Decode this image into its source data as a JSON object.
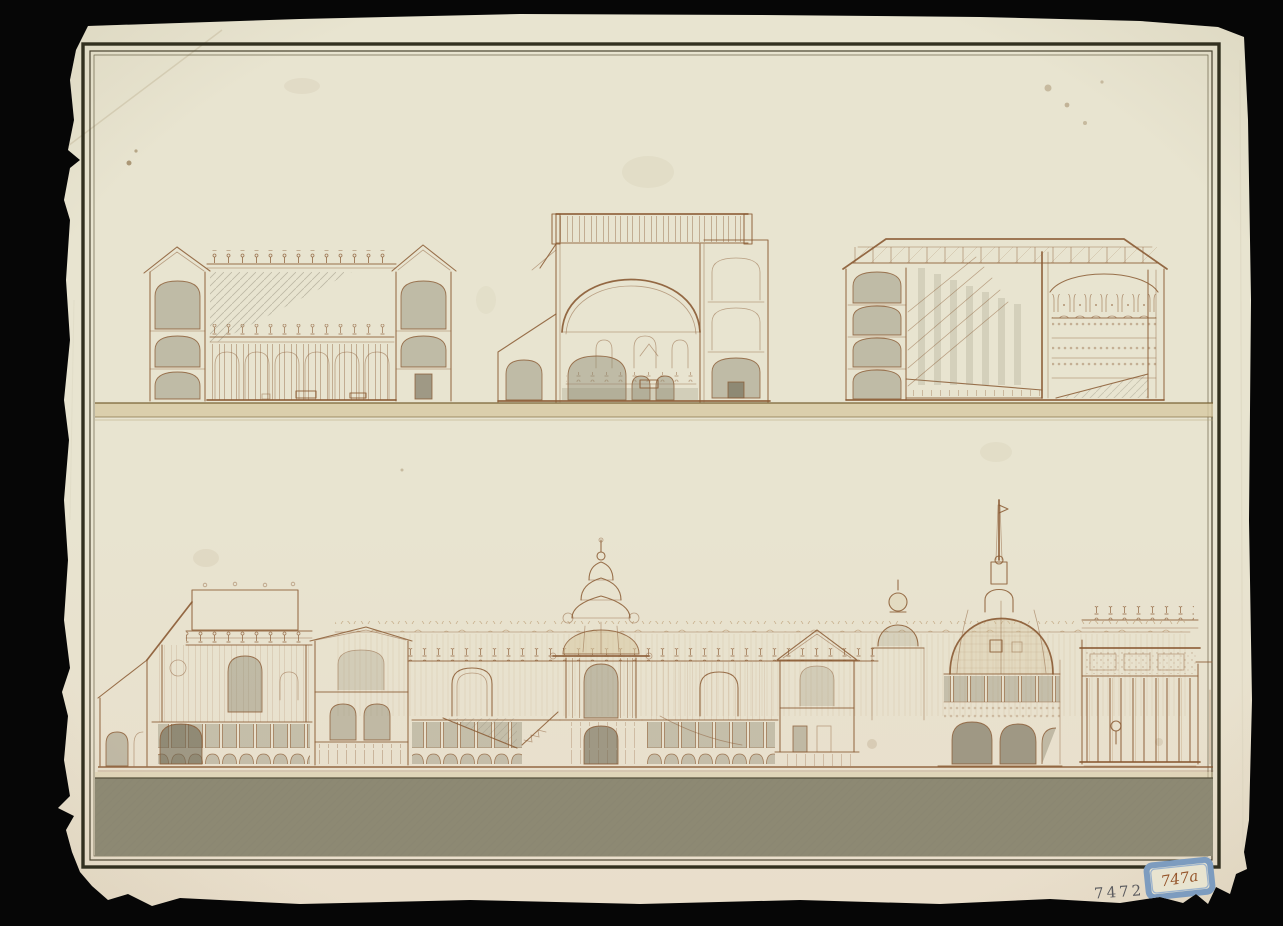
{
  "scene": {
    "stamp_number": "7472",
    "label_number": "747a"
  },
  "colors": {
    "bg": "#060606",
    "paper": "#e8e4d0",
    "paper_low": "#e9decb",
    "frame": "#32301f",
    "ink": "#8a5a33",
    "ink_light": "#a87f4e",
    "wash_warm": "#d7c9a3",
    "wash_grey": "#8f8a74",
    "wash_dark": "#6e6853",
    "band_grey": "#8d8973",
    "label_blue": "#7d9cbf",
    "stamp_ink": "#43454d",
    "stain": "#7a5a2e"
  }
}
